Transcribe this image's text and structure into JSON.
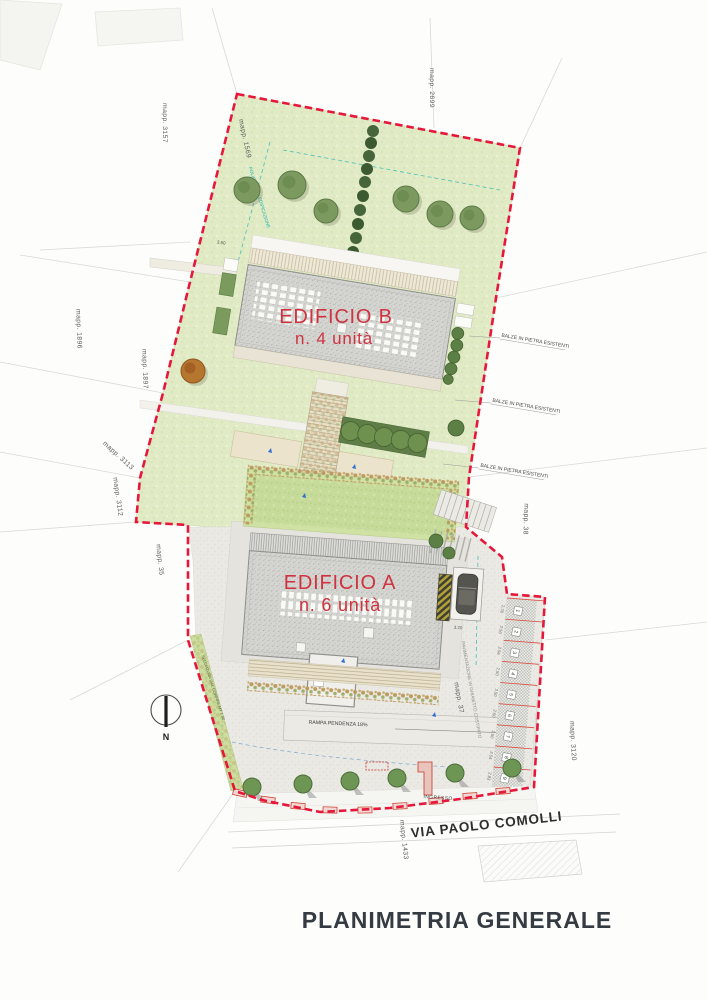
{
  "title": "PLANIMETRIA GENERALE",
  "street": {
    "name": "VIA PAOLO COMOLLI",
    "entrance": "INGRESSO"
  },
  "north": "N",
  "buildings": {
    "b": {
      "name": "EDIFICIO B",
      "units": "n. 4 unità"
    },
    "a": {
      "name": "EDIFICIO A",
      "units": "n. 6 unità"
    }
  },
  "parcels": {
    "p2699": "mapp. 2699",
    "p3157": "mapp. 3157",
    "p1569": "mapp. 1569",
    "p1896": "mapp. 1896",
    "p1897": "mapp. 1897",
    "p3113": "mapp. 3113",
    "p3112": "mapp. 3112",
    "p35": "mapp. 35",
    "p38": "mapp. 38",
    "p37": "mapp. 37",
    "p3120": "mapp. 3120",
    "p1433": "mapp. 1433"
  },
  "annotations": {
    "balze": "BALZE IN PIETRA ESISTENTI",
    "rampa": "RAMPA PENDENZA 18%",
    "paving": "PAVIMENTAZIONE IN GHIAIETTO COSTIPATO",
    "boundary_strip": "SELCIATURA DAL CONFINE MT 1.50",
    "envelope": "POLIGONO DI EDIFICAZIONE"
  },
  "dimensions": {
    "b_top": "3.50",
    "a_right": "3.20",
    "stalls": [
      "2.78",
      "2.50",
      "2.56",
      "2.50",
      "2.50",
      "2.50",
      "2.50",
      "2.54",
      "2.83"
    ]
  },
  "parking": {
    "stalls": [
      "1",
      "2",
      "3",
      "4",
      "5",
      "6",
      "7",
      "8",
      "9"
    ]
  },
  "colors": {
    "boundary": "#e5173a",
    "envelope_line": "#35c4bc",
    "building_label": "#cf3340",
    "lawn": "#e0eac5",
    "title_color": "#353b43"
  }
}
